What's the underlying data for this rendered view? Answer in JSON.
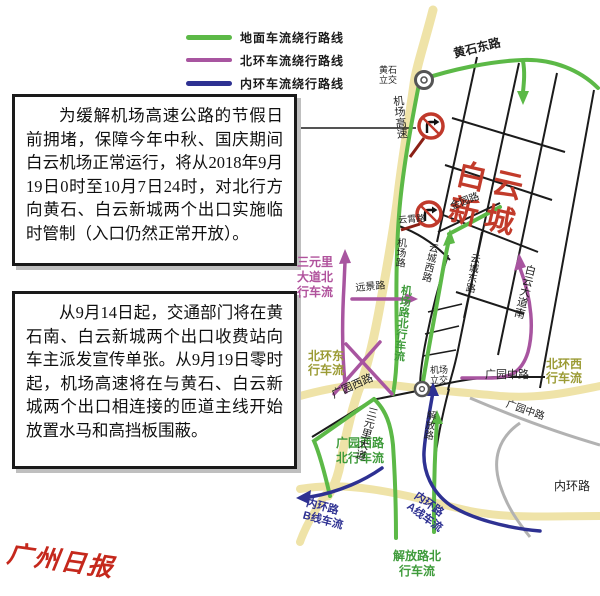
{
  "legend": {
    "items": [
      {
        "label": "地面车流绕行路线",
        "color": "#5cb947"
      },
      {
        "label": "北环车流绕行路线",
        "color": "#a855a0"
      },
      {
        "label": "内环车流绕行路线",
        "color": "#2e3192"
      }
    ]
  },
  "notices": {
    "first": "为缓解机场高速公路的节假日前拥堵，保障今年中秋、国庆期间白云机场正常运行，将从2018年9月19日0时至10月7日24时，对北行方向黄石、白云新城两个出口实施临时管制（入口仍然正常开放）。",
    "second": "从9月14日起，交通部门将在黄石南、白云新城两个出口收费站向车主派发宣传单张。从9月19日零时起，机场高速将在与黄石、白云新城两个出口相连接的匝道主线开始放置水马和高挡板围蔽。"
  },
  "map": {
    "labels": {
      "huangshi_dong_lu": "黄石东路",
      "huangshi_lijiao": "黄石\n立交",
      "jichang_gaosu": "机场高速",
      "baiyun_xincheng": "白云\n新城",
      "jin_yuan_lu": "金园路",
      "yun_xiao_lu": "云霄路",
      "jichang_lu": "机场路",
      "yuncheng_xi_lu": "云城西路",
      "yuncheng_dong_lu": "云城东路",
      "baiyun_dadao_nan": "白云大道南",
      "sanyuanli_flow": "三元里\n大道北\n行车流",
      "yuanjing_lu": "远景路",
      "jichanglu_flow": "机场路北行车流",
      "jichang_lijiao": "机场\n立交",
      "beihuan_dong_flow": "北环东\n行车流",
      "beihuan_xi_flow": "北环西\n行车流",
      "guangyuan_xi_lu": "广园西路",
      "guangyuan_xi_flow": "广园西路\n北行车流",
      "sanyuanli_dadao": "三元里大道",
      "jiefang_lu": "解放路",
      "guangyuan_zhong_lu_1": "广园中路",
      "guangyuan_zhong_lu_2": "广园中路",
      "neihuan_lu": "内环路",
      "neihuan_b_flow": "内环路\nB线车流",
      "neihuan_a_flow": "内环路\nA线车流",
      "jiefang_flow": "解放路北\n行车流"
    },
    "colors": {
      "ground_route_green": "#5cb947",
      "north_ring_purple": "#a855a0",
      "inner_ring_navy": "#2e3192",
      "expressway_yellow": "#efe3a8",
      "closure_sign_red": "#c0392b",
      "district_red": "#c23b2b",
      "flow_olive": "#9b9b35"
    }
  },
  "logo": {
    "name": "广州日报"
  }
}
